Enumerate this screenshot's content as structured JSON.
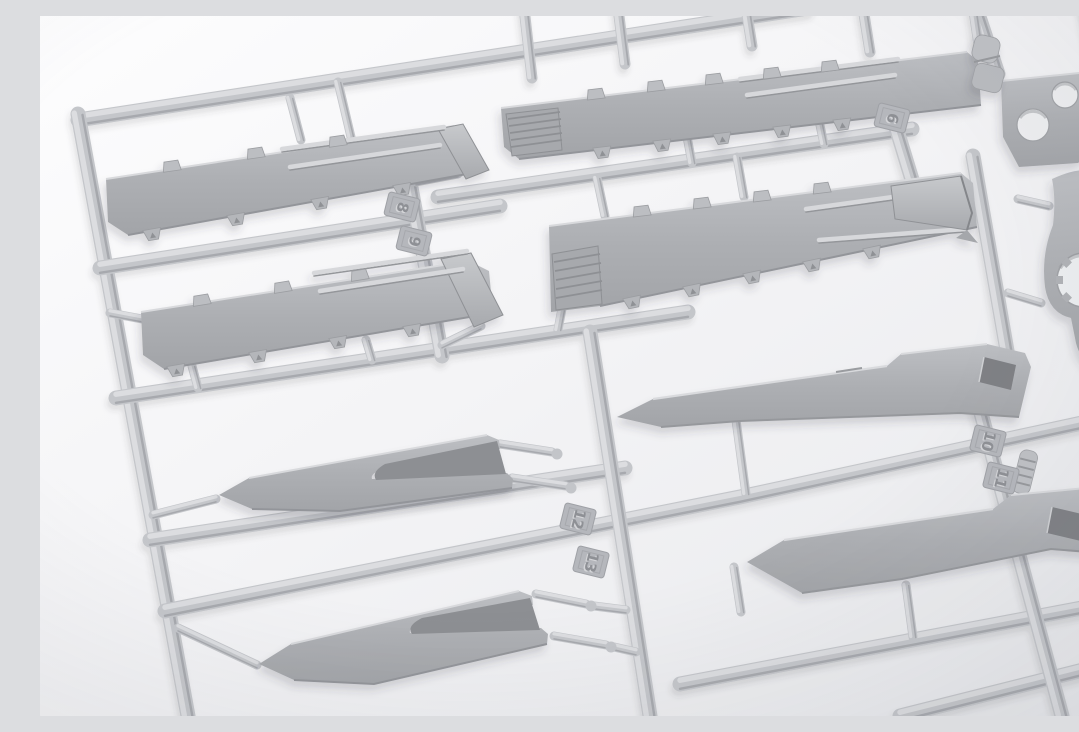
{
  "scene": {
    "description": "Macro photograph of a light-grey injection-moulded plastic model-kit sprue (parts tree) lying on a bright white surface, shot at an oblique angle with the runners forming a slanted grid",
    "subject": "plastic model kit sprue with fender plates, forked skirt parts, slotted side panels and small brackets",
    "background_color": "#f4f4f6",
    "plastic_color": "#aeb0b4",
    "runner_color": "#c4c6ca"
  },
  "part_number_tags": [
    {
      "label": "6"
    },
    {
      "label": "8"
    },
    {
      "label": "9"
    },
    {
      "label": "10"
    },
    {
      "label": "11"
    },
    {
      "label": "12"
    },
    {
      "label": "13"
    }
  ],
  "parts": [
    {
      "name": "fender-plate-top-left"
    },
    {
      "name": "fender-plate-top-right"
    },
    {
      "name": "fender-plate-mid-left"
    },
    {
      "name": "fender-plate-mid-right"
    },
    {
      "name": "forked-skirt-upper"
    },
    {
      "name": "forked-skirt-lower"
    },
    {
      "name": "side-panel-upper-right"
    },
    {
      "name": "side-panel-lower-right"
    },
    {
      "name": "hub-plate-right-edge"
    },
    {
      "name": "two-hole-bracket-top-right"
    },
    {
      "name": "segmented-cylinder-top-right"
    }
  ]
}
